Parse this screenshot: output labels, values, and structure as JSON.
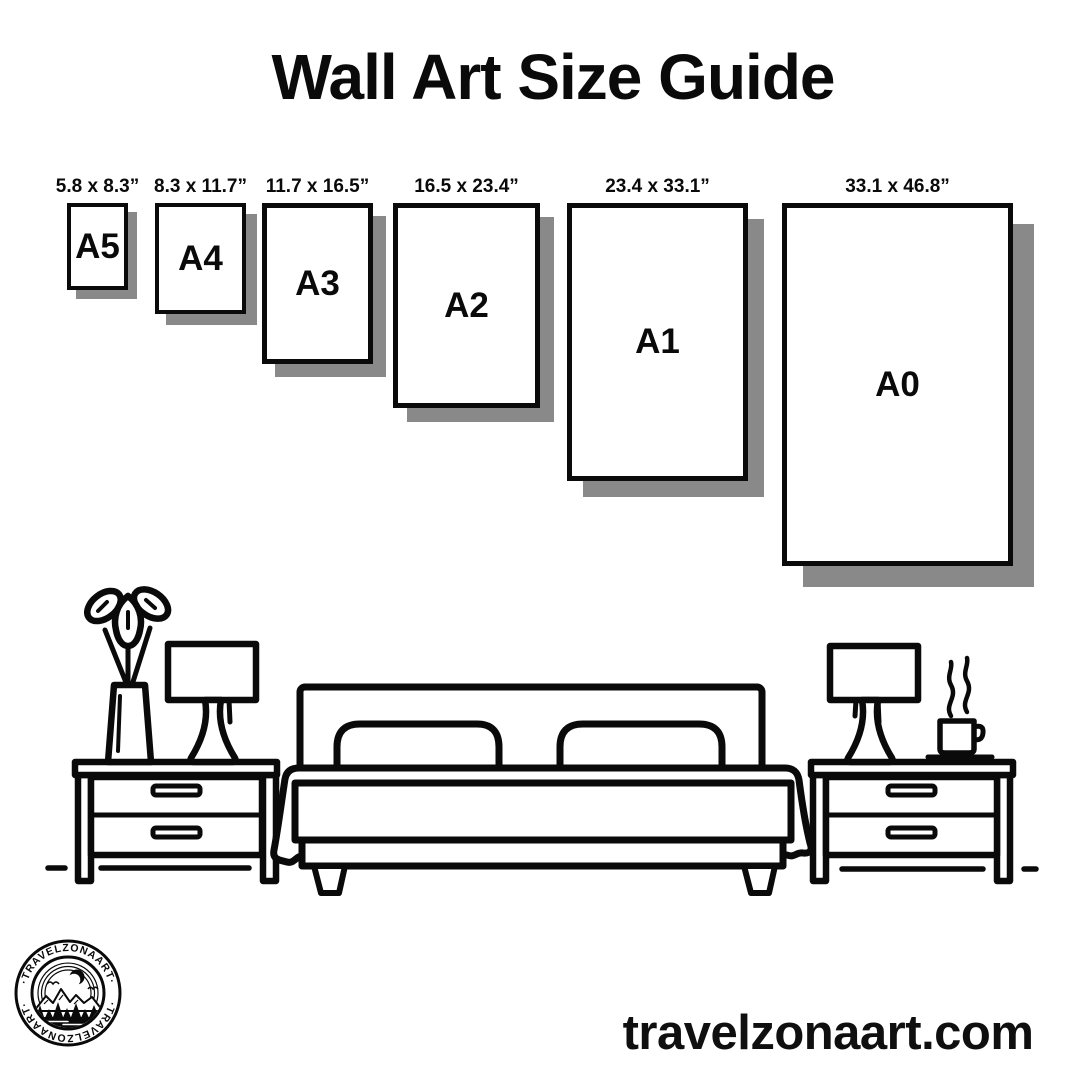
{
  "title": "Wall Art Size Guide",
  "colors": {
    "ink": "#0a0a0a",
    "shadow": "#898989",
    "background": "#ffffff"
  },
  "size_guide": {
    "items": [
      {
        "label": "A5",
        "dimensions": "5.8 x 8.3”"
      },
      {
        "label": "A4",
        "dimensions": "8.3 x 11.7”"
      },
      {
        "label": "A3",
        "dimensions": "11.7 x 16.5”"
      },
      {
        "label": "A2",
        "dimensions": "16.5 x 23.4”"
      },
      {
        "label": "A1",
        "dimensions": "23.4 x 33.1”"
      },
      {
        "label": "A0",
        "dimensions": "33.1 x 46.8”"
      }
    ]
  },
  "scene": {
    "icons": [
      "flower-vase",
      "table-lamp",
      "nightstand",
      "double-bed",
      "coffee-cup"
    ]
  },
  "logo": {
    "arc_text": "·TRAVELZONAART·"
  },
  "footer": {
    "website": "travelzonaart.com"
  }
}
